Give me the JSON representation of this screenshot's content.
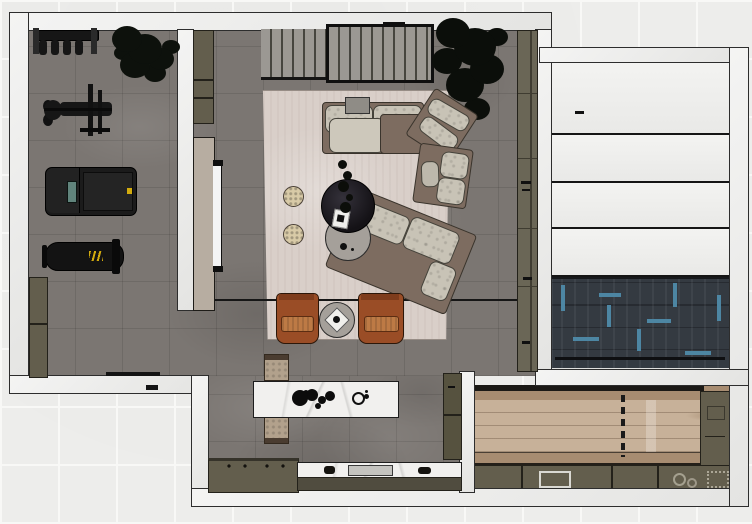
{
  "scene": {
    "kind": "floor-plan-render",
    "view": "top-down",
    "visible_text": [],
    "rooms": [
      {
        "id": "gym",
        "label": "home-gym",
        "floor": "dark-gray-tile",
        "items": [
          "dumbbell-rack",
          "potted-plant",
          "strength-machine",
          "treadmill",
          "workout-bench",
          "storage-cabinet",
          "entry-door-marking"
        ]
      },
      {
        "id": "living",
        "label": "living-room",
        "floor": "dark-gray-tile",
        "items": [
          "slatted-panel-small",
          "slatted-panel-large",
          "potted-plant",
          "area-rug",
          "corner-sectional-sofa",
          "chaise-module",
          "sofa-tray",
          "dark-round-coffee-table",
          "gray-round-coffee-table",
          "table-plant",
          "white-deco-box",
          "pouf",
          "pouf",
          "leather-armchair",
          "leather-armchair",
          "round-side-table",
          "tv-on-partition",
          "media-panel",
          "partition-cabinet",
          "tall-wall-cabinet",
          "floor-seam-line"
        ]
      },
      {
        "id": "kitchen",
        "label": "kitchen",
        "floor": "dark-gray-tile",
        "items": [
          "marble-island",
          "island-decor",
          "island-trivet",
          "stool",
          "stool",
          "cooktop-counter",
          "burners",
          "marble-counter",
          "sink",
          "counter-base",
          "tall-cabinet"
        ]
      },
      {
        "id": "garage",
        "label": "right-room",
        "floor": "dark-herringbone-with-blue-accents",
        "items": [
          "white-panel",
          "white-panel",
          "white-panel",
          "white-panel",
          "panel-mark"
        ]
      },
      {
        "id": "utility",
        "label": "bottom-right-room",
        "floor": "light-wood-planks",
        "items": [
          "perimeter-counter-bottom",
          "perimeter-counter-right",
          "sink-outline",
          "dashed-divider-line",
          "wood-table-band"
        ]
      }
    ]
  },
  "palette": {
    "tile": "#ededeb",
    "grout": "#f8f8f6",
    "wall": "#ececeb",
    "wall-edge": "#2d2d2d",
    "floor": "#7b7672",
    "rug": "#d9cfc9",
    "sofa": "#7d6c60",
    "cushion": "#c8c3b6",
    "rust": "#9a4d26",
    "rust-seat": "#bd7a45",
    "dark": "#18161a",
    "gray-table": "#a5a09a",
    "pouf": "#d8caa7",
    "olive": "#635e4d",
    "olive-dark": "#3c392e",
    "marble": "#f1f0ee",
    "herring": "#343a41",
    "herring-blue": "#4d86a3",
    "wood": "#c7b199",
    "wood-mid": "#a78c71",
    "wood-dark": "#5f5245",
    "panel": "#efeeec",
    "beige": "#b7ada1",
    "slat": "#9b9893",
    "stool": "#b2a18c",
    "equip": "#161616",
    "tv": "#f4f4f4",
    "accent-yellow": "#d2ab0e",
    "screen-teal": "#61847c"
  }
}
